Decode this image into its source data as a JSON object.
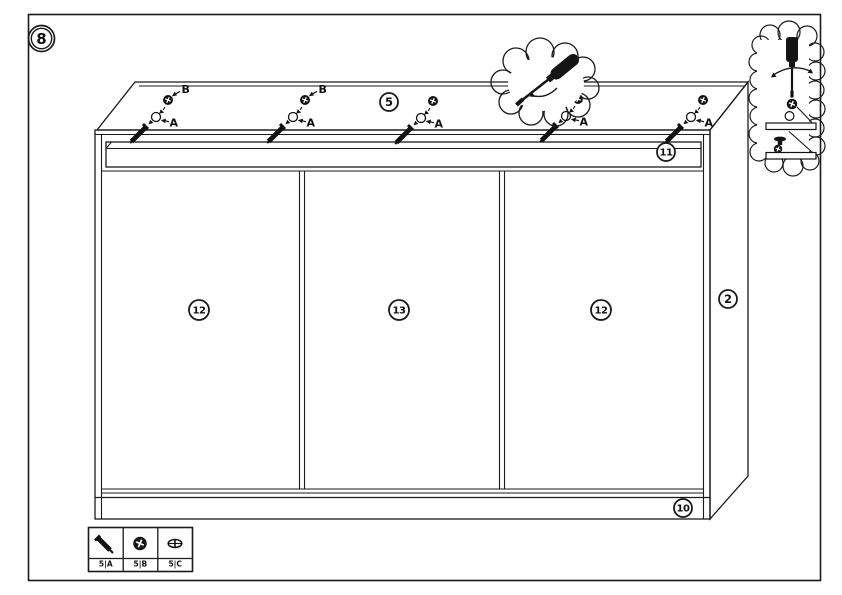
{
  "step": {
    "number": "8"
  },
  "assembly": {
    "part_labels": {
      "top_panel": "5",
      "top_rail": "11",
      "left_door": "12",
      "middle_door": "13",
      "right_door": "12",
      "right_side_panel": "2",
      "bottom_rail": "10"
    },
    "callouts": [
      {
        "hole_label": "A",
        "screw_label": "B"
      },
      {
        "hole_label": "A",
        "screw_label": "B"
      },
      {
        "hole_label": "A"
      },
      {
        "hole_label": "A"
      },
      {
        "hole_label": "A"
      }
    ],
    "tool_bubbles": [
      {
        "icon": "screwdriver-rotation-icon"
      },
      {
        "icon": "screwdriver-section-detail-icon"
      }
    ]
  },
  "legend": {
    "items": [
      {
        "icon": "screw-icon",
        "label": "5|A"
      },
      {
        "icon": "cam-screw-icon",
        "label": "5|B"
      },
      {
        "icon": "screw-head-icon",
        "label": "5|C"
      }
    ]
  },
  "colors": {
    "line": "#1a1a1a",
    "background": "#ffffff"
  }
}
